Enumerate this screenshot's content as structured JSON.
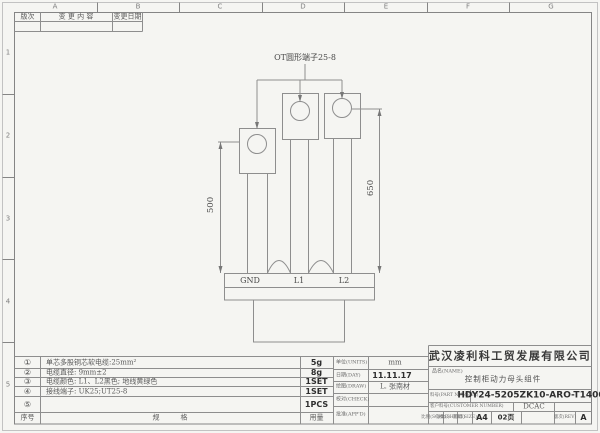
{
  "colors": {
    "paper": "#f5f5f2",
    "line": "#8e8e8e",
    "ink": "#2e2e2e"
  },
  "sheet": {
    "col_labels": [
      "A",
      "B",
      "C",
      "D",
      "E",
      "F",
      "G"
    ],
    "row_labels": [
      "1",
      "2",
      "3",
      "4",
      "5"
    ]
  },
  "revision_table": {
    "rev_col": "版次",
    "content_col": "变 更 内 容",
    "date_col": "变更日期"
  },
  "drawing": {
    "annotation": "OT圆形端子25-8",
    "dim_left": "500",
    "dim_right": "650",
    "terminal_labels": [
      "GND",
      "L1",
      "L2"
    ]
  },
  "bom": {
    "rows": [
      {
        "no": "①",
        "spec": "单芯多股铜芯软电缆:25mm²",
        "qty": "5g"
      },
      {
        "no": "②",
        "spec": "电缆直径: 9mm±2",
        "qty": "8g"
      },
      {
        "no": "③",
        "spec": "电缆颜色: L1、L2黑色; 地线黄绿色",
        "qty": "1SET"
      },
      {
        "no": "④",
        "spec": "接线端子: UK25;UT25-8",
        "qty": "1SET"
      },
      {
        "no": "⑤",
        "spec": "",
        "qty": "1PCS"
      }
    ],
    "footer": {
      "no": "序号",
      "spec": "规　　　格",
      "qty": "用量"
    }
  },
  "sign_block": {
    "rows": [
      {
        "label": "单位(UNITS)",
        "value": "mm"
      },
      {
        "label": "日期(DAY)",
        "value": "11.11.17"
      },
      {
        "label": "绘图(DRAW)",
        "value": "L.  张南材"
      },
      {
        "label": "校对(CHECK)",
        "value": ""
      },
      {
        "label": "批准(APP'D)",
        "value": ""
      }
    ]
  },
  "title_block": {
    "company": "武汉凌利科工贸发展有限公司",
    "name_label": "品名(NAME)",
    "name_value": "控制柜动力母头组件",
    "part_label": "料号(PART NUMBER)",
    "part_value": "HDY24-5205ZK10-ARO-T1400",
    "customer_label": "客户料号(CUSTOMER NUMBER)",
    "customer_value": "DCAC",
    "scale_label": "比例(SCALE)",
    "sheet_label": "张数(SHEET)",
    "size_label": "图幅(SIZE)",
    "size_value": "A4",
    "pages_value": "02页",
    "rev_label": "版次(REV)",
    "rev_value": "A"
  }
}
